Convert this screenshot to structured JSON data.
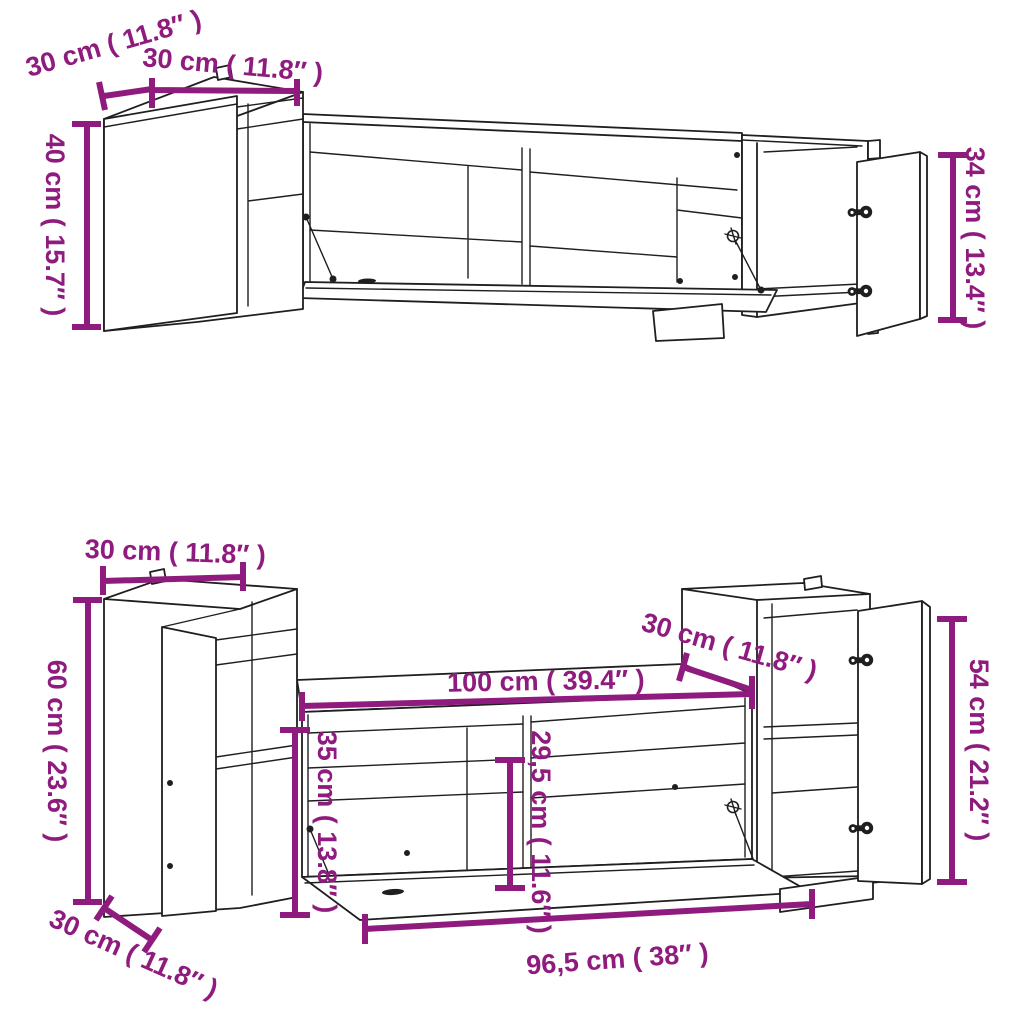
{
  "colors": {
    "dimension_accent": "#8E1B7D",
    "line_art": "#1F1F1F",
    "background": "#FFFFFF"
  },
  "figure": {
    "kind": "furniture dimension line drawing",
    "views": [
      "wall-mounted tv cabinet set - upper composition",
      "wall-mounted tv cabinet set - lower composition"
    ]
  },
  "top_unit": {
    "dims": {
      "depth_left": "30 cm ( 11.8″ )",
      "width_left": "30 cm ( 11.8″ )",
      "height_left": "40 cm ( 15.7″ )",
      "height_right": "34 cm ( 13.4″ )"
    }
  },
  "bottom_unit": {
    "dims": {
      "width_left": "30 cm ( 11.8″ )",
      "height_left": "60 cm ( 23.6″ )",
      "depth_left": "30 cm ( 11.8″ )",
      "bench_width": "100 cm ( 39.4″ )",
      "bench_depth": "30 cm ( 11.8″ )",
      "bench_height": "35 cm ( 13.8″ )",
      "inner_height": "29,5 cm ( 11.6″ )",
      "flap_width": "96,5 cm ( 38″ )",
      "height_right": "54 cm ( 21.2″ )"
    }
  }
}
